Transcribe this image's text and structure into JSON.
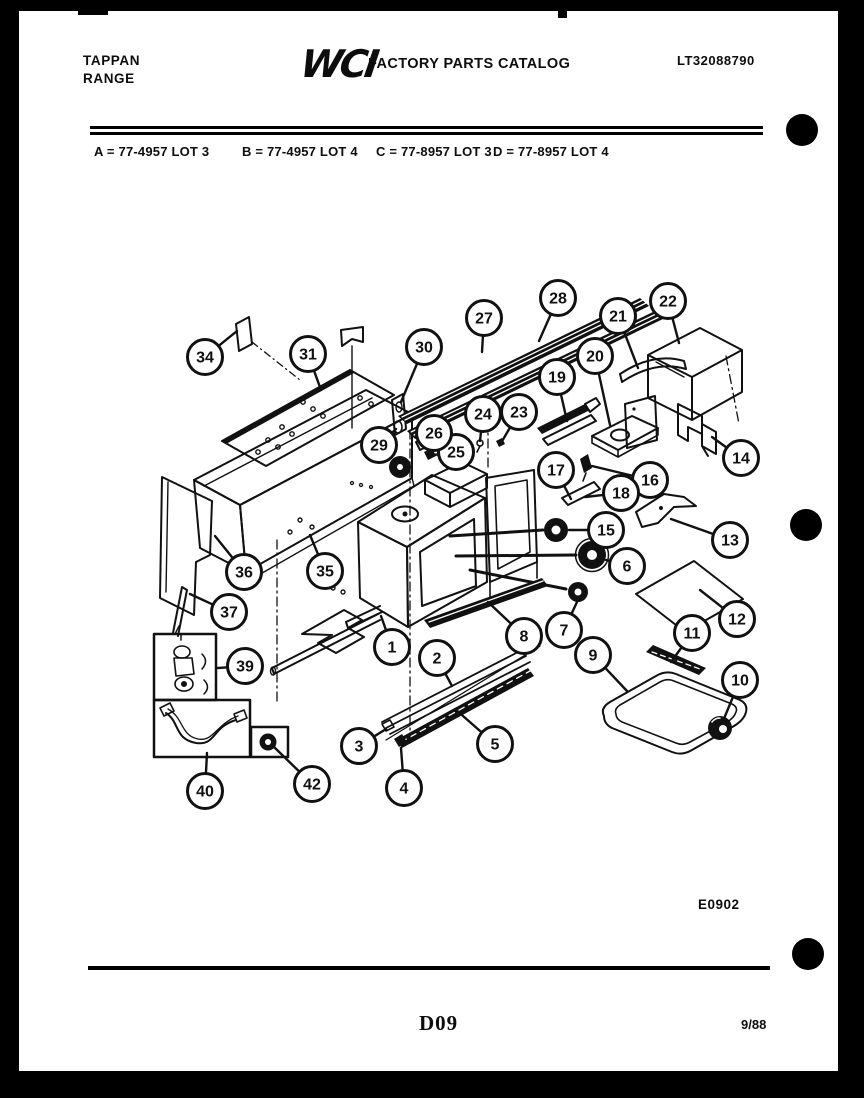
{
  "header": {
    "brand_line1": "TAPPAN",
    "brand_line2": "RANGE",
    "logo_text": "WCI",
    "catalog_title": "FACTORY PARTS CATALOG",
    "doc_number": "LT32088790"
  },
  "model_legend": {
    "item_a": "A = 77-4957 LOT 3",
    "item_b": "B = 77-4957 LOT 4",
    "item_c": "C = 77-8957 LOT 3",
    "item_d": "D = 77-8957 LOT 4"
  },
  "diagram": {
    "figure_code": "E0902",
    "callouts": [
      {
        "n": "1",
        "x": 392,
        "y": 647,
        "lx": 381,
        "ly": 616
      },
      {
        "n": "2",
        "x": 437,
        "y": 658,
        "lx": 452,
        "ly": 686
      },
      {
        "n": "3",
        "x": 359,
        "y": 746,
        "lx": 386,
        "ly": 729
      },
      {
        "n": "4",
        "x": 404,
        "y": 788,
        "lx": 401,
        "ly": 748
      },
      {
        "n": "5",
        "x": 495,
        "y": 744,
        "lx": 455,
        "ly": 709
      },
      {
        "n": "6",
        "x": 627,
        "y": 566,
        "lx": 606,
        "ly": 560
      },
      {
        "n": "7",
        "x": 564,
        "y": 630,
        "lx": 577,
        "ly": 602
      },
      {
        "n": "8",
        "x": 524,
        "y": 636,
        "lx": 488,
        "ly": 602
      },
      {
        "n": "9",
        "x": 593,
        "y": 655,
        "lx": 627,
        "ly": 691
      },
      {
        "n": "10",
        "x": 740,
        "y": 680,
        "lx": 723,
        "ly": 721
      },
      {
        "n": "11",
        "x": 692,
        "y": 633,
        "lx": 671,
        "ly": 662
      },
      {
        "n": "12",
        "x": 737,
        "y": 619,
        "lx": 700,
        "ly": 590
      },
      {
        "n": "13",
        "x": 730,
        "y": 540,
        "lx": 671,
        "ly": 519
      },
      {
        "n": "14",
        "x": 741,
        "y": 458,
        "lx": 712,
        "ly": 437
      },
      {
        "n": "15",
        "x": 606,
        "y": 530,
        "lx": 569,
        "ly": 530
      },
      {
        "n": "16",
        "x": 650,
        "y": 480,
        "lx": 592,
        "ly": 466
      },
      {
        "n": "17",
        "x": 556,
        "y": 470,
        "lx": 571,
        "ly": 499
      },
      {
        "n": "18",
        "x": 621,
        "y": 493,
        "lx": 585,
        "ly": 497
      },
      {
        "n": "19",
        "x": 557,
        "y": 377,
        "lx": 567,
        "ly": 421
      },
      {
        "n": "20",
        "x": 595,
        "y": 356,
        "lx": 610,
        "ly": 425
      },
      {
        "n": "21",
        "x": 618,
        "y": 316,
        "lx": 638,
        "ly": 368
      },
      {
        "n": "22",
        "x": 668,
        "y": 301,
        "lx": 679,
        "ly": 343
      },
      {
        "n": "23",
        "x": 519,
        "y": 412,
        "lx": 501,
        "ly": 443
      },
      {
        "n": "24",
        "x": 483,
        "y": 414,
        "lx": 480,
        "ly": 441
      },
      {
        "n": "25",
        "x": 456,
        "y": 452,
        "lx": 433,
        "ly": 455
      },
      {
        "n": "26",
        "x": 434,
        "y": 433,
        "lx": 425,
        "ly": 444
      },
      {
        "n": "27",
        "x": 484,
        "y": 318,
        "lx": 482,
        "ly": 352
      },
      {
        "n": "28",
        "x": 558,
        "y": 298,
        "lx": 539,
        "ly": 341
      },
      {
        "n": "29",
        "x": 379,
        "y": 445,
        "lx": 396,
        "ly": 429
      },
      {
        "n": "30",
        "x": 424,
        "y": 347,
        "lx": 401,
        "ly": 402
      },
      {
        "n": "31",
        "x": 308,
        "y": 354,
        "lx": 321,
        "ly": 390
      },
      {
        "n": "34",
        "x": 205,
        "y": 357,
        "lx": 237,
        "ly": 331
      },
      {
        "n": "35",
        "x": 325,
        "y": 571,
        "lx": 310,
        "ly": 535
      },
      {
        "n": "36",
        "x": 244,
        "y": 572,
        "lx": 215,
        "ly": 536
      },
      {
        "n": "37",
        "x": 229,
        "y": 612,
        "lx": 190,
        "ly": 594
      },
      {
        "n": "39",
        "x": 245,
        "y": 666,
        "lx": 218,
        "ly": 668
      },
      {
        "n": "40",
        "x": 205,
        "y": 791,
        "lx": 207,
        "ly": 753
      },
      {
        "n": "42",
        "x": 312,
        "y": 784,
        "lx": 272,
        "ly": 745
      }
    ]
  },
  "footer": {
    "page_code": "D09",
    "date_code": "9/88"
  }
}
